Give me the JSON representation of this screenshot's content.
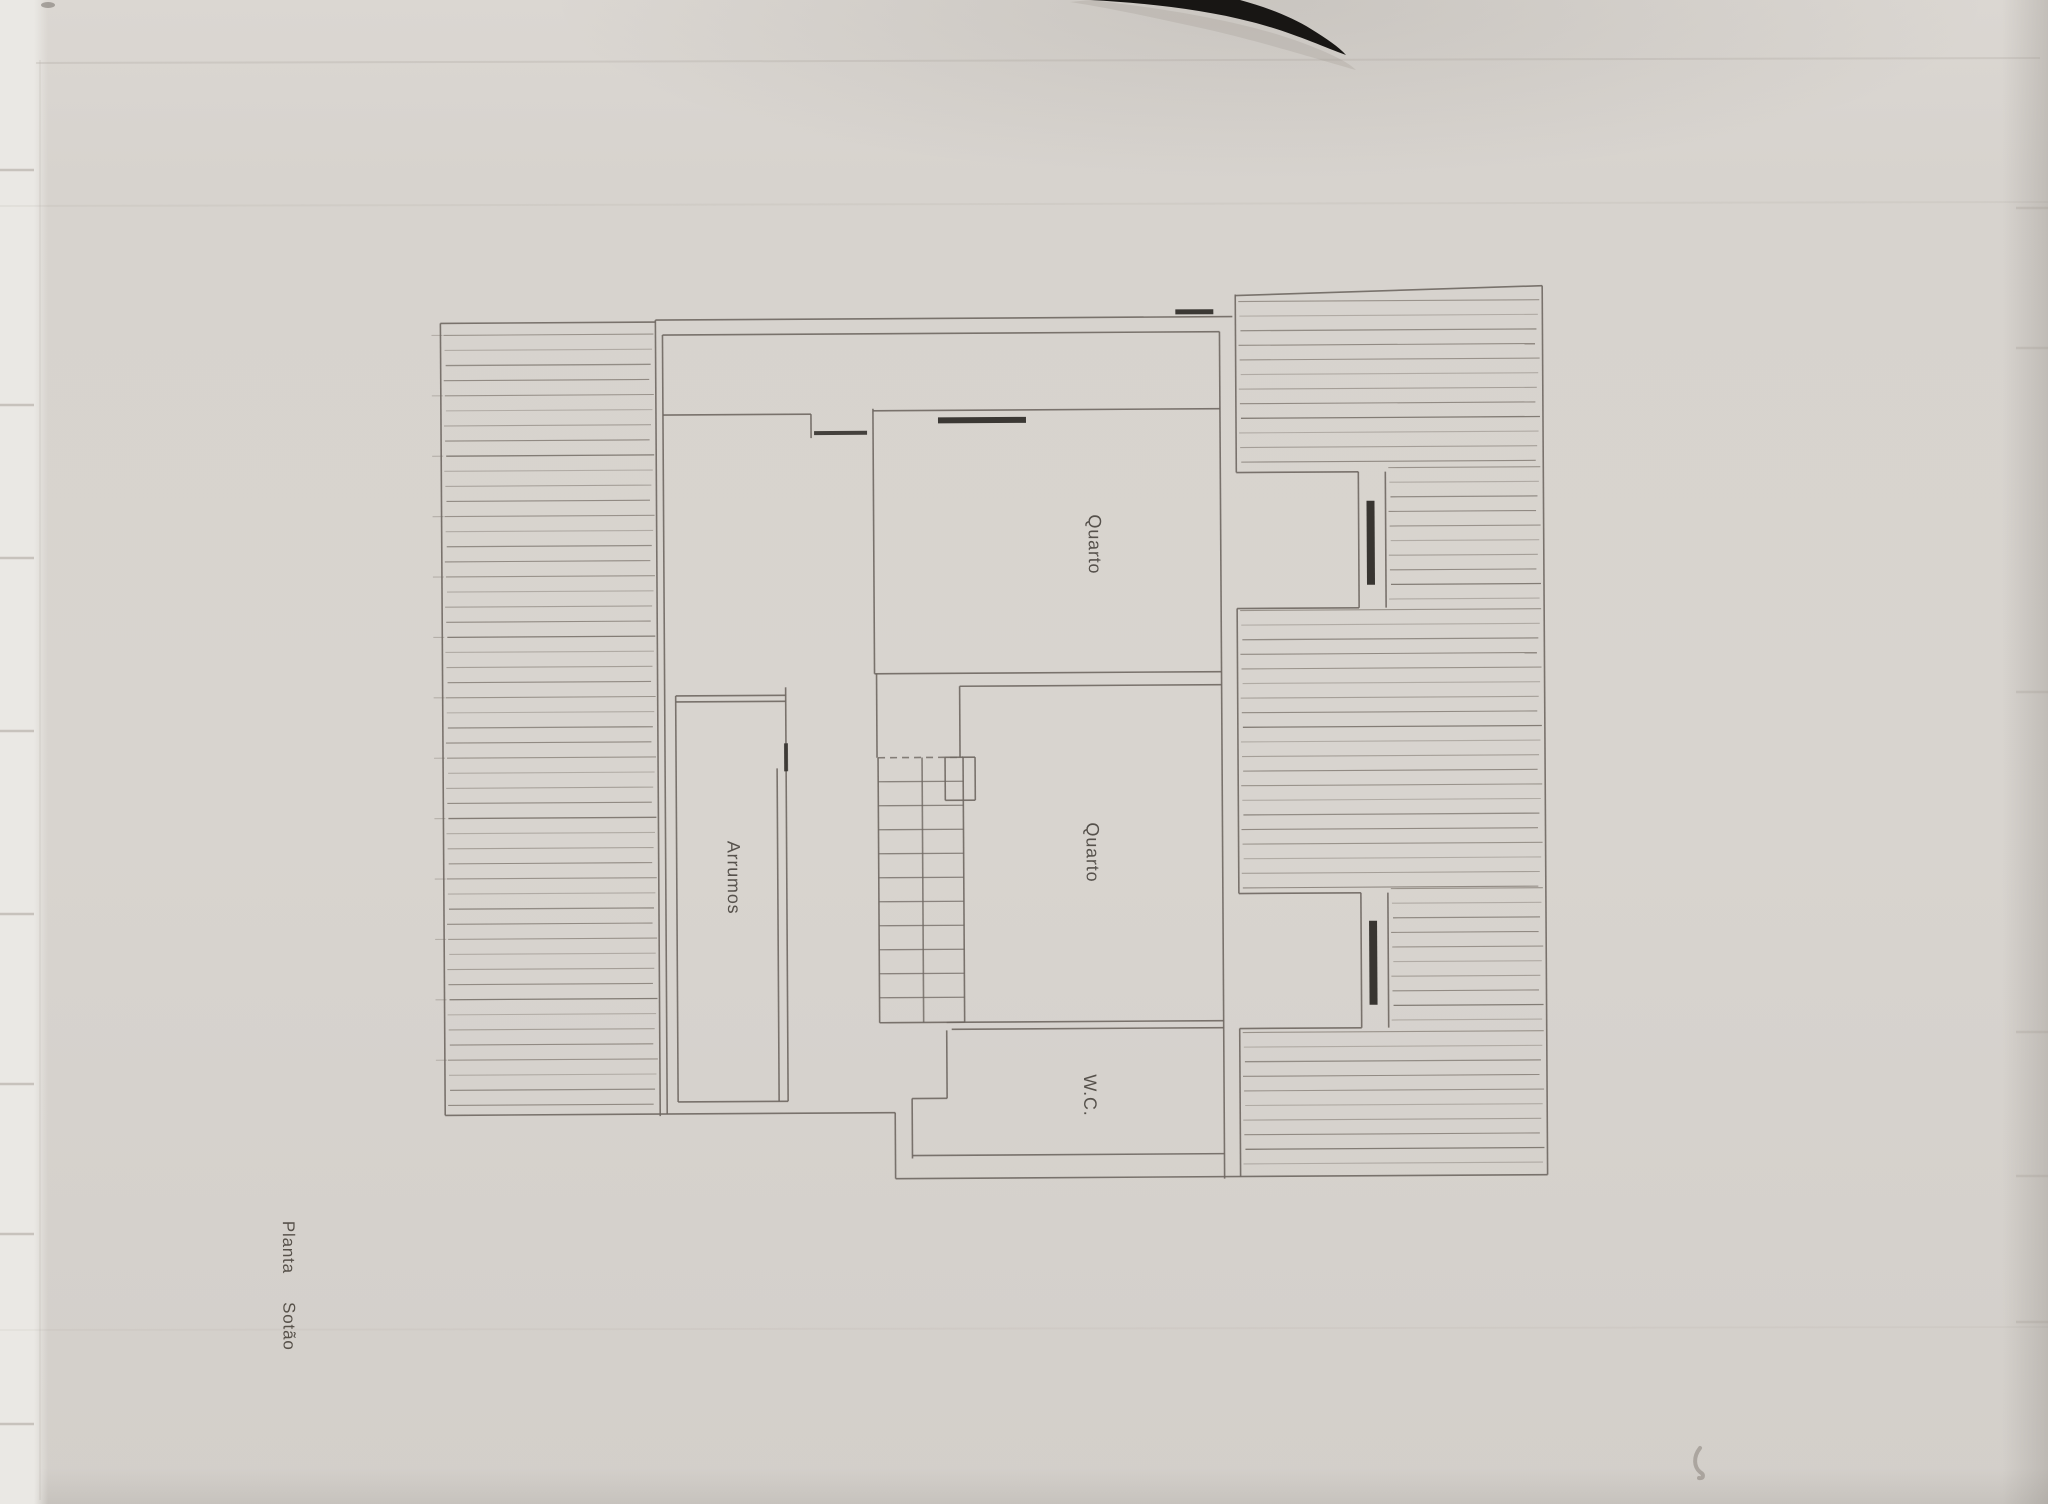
{
  "document": {
    "kind": "scanned architectural floor plan",
    "plan_title": "Planta Sotão",
    "plan_title_words": [
      "Planta",
      "Sotão"
    ],
    "text_orientation": "rotated-90-degrees",
    "rooms": [
      {
        "id": "quarto-1",
        "label": "Quarto"
      },
      {
        "id": "quarto-2",
        "label": "Quarto"
      },
      {
        "id": "arrumos",
        "label": "Arrumos"
      },
      {
        "id": "wc",
        "label": "W.C."
      }
    ],
    "features": [
      "hatched roof/terrace areas",
      "staircase with landing",
      "window bars drawn as thick dark segments"
    ]
  },
  "colors": {
    "paper": "#d8d4cf",
    "wall_line": "#6f6862",
    "hatch_line": "#8a837b",
    "window_bar": "#2b2824",
    "scan_blob": "#181614",
    "label_ink": "#45403a"
  }
}
